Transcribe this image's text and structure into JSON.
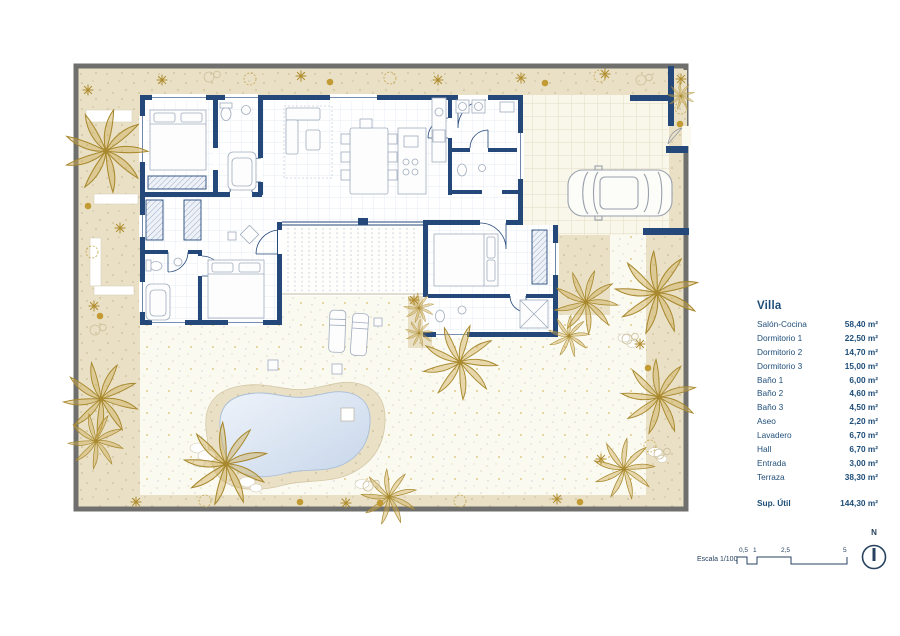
{
  "legend": {
    "title": "Villa",
    "items": [
      {
        "label": "Salón-Cocina",
        "value": "58,40 m²"
      },
      {
        "label": "Dormitorio 1",
        "value": "22,50 m²"
      },
      {
        "label": "Dormitorio 2",
        "value": "14,70 m²"
      },
      {
        "label": "Dormitorio 3",
        "value": "15,00 m²"
      },
      {
        "label": "Baño 1",
        "value": "6,00 m²"
      },
      {
        "label": "Baño 2",
        "value": "4,60 m²"
      },
      {
        "label": "Baño 3",
        "value": "4,50 m²"
      },
      {
        "label": "Aseo",
        "value": "2,20 m²"
      },
      {
        "label": "Lavadero",
        "value": "6,70 m²"
      },
      {
        "label": "Hall",
        "value": "6,70 m²"
      },
      {
        "label": "Entrada",
        "value": "3,00 m²"
      },
      {
        "label": "Terraza",
        "value": "38,30 m²"
      }
    ],
    "total_label": "Sup. Útil",
    "total_value": "144,30 m²"
  },
  "scale_bar": {
    "label": "Escala 1/100",
    "ticks": [
      "0,5",
      "1",
      "2,5",
      "5"
    ]
  },
  "compass": {
    "label": "N"
  },
  "colors": {
    "wall_navy": "#25487b",
    "text_navy": "#1f4e79",
    "sand": "#e9e1c8",
    "gold": "#b8962f",
    "pool_water": "#d3dff0",
    "plot_border": "#6f6f6d"
  },
  "icons": [
    {
      "name": "compass-icon",
      "shape": "circle-with-north-needle"
    },
    {
      "name": "palm-tree-icon",
      "shape": "radial-frond-cluster"
    },
    {
      "name": "car-icon",
      "shape": "top-view-car-outline"
    },
    {
      "name": "pool",
      "shape": "kidney-blob"
    }
  ]
}
